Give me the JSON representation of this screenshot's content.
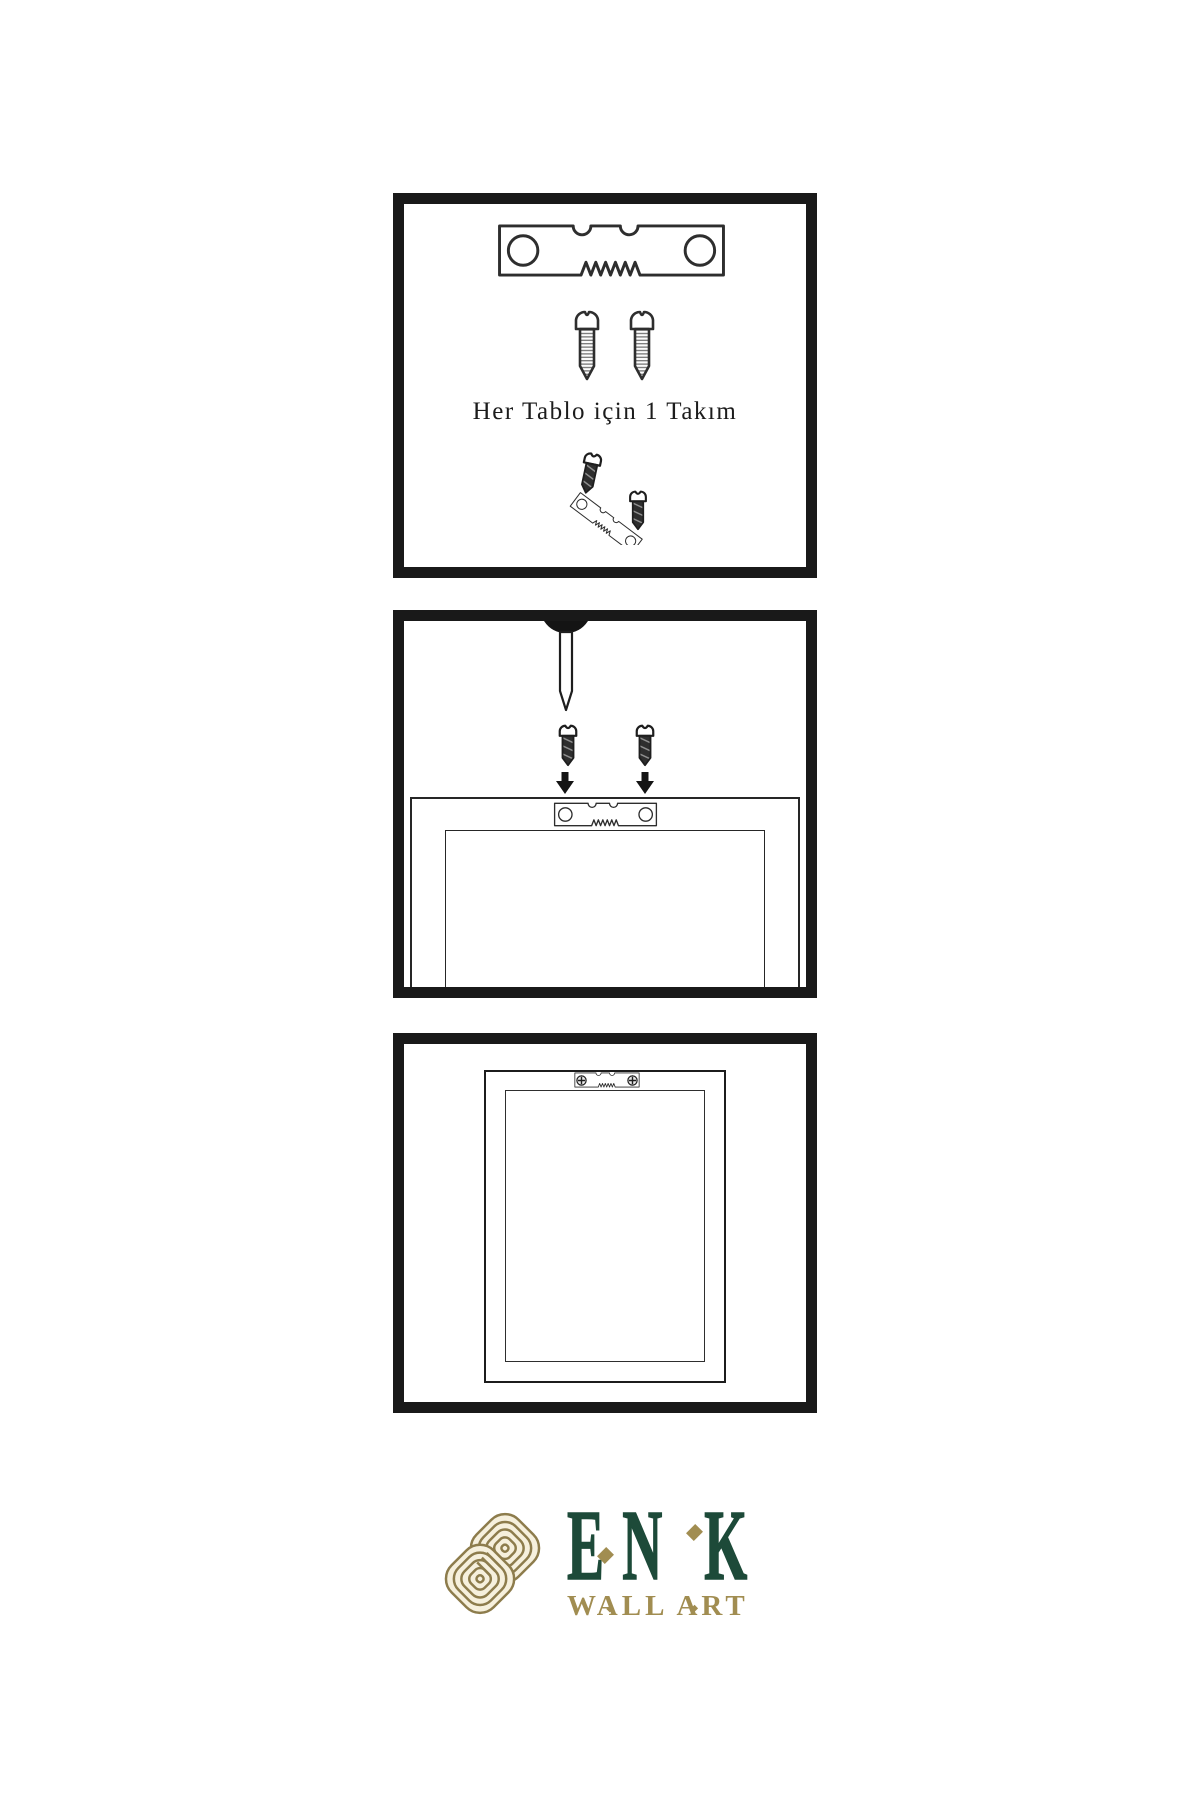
{
  "page": {
    "background": "#ffffff"
  },
  "instruction_panels": {
    "kit": {
      "caption": "Her Tablo için 1 Takım"
    },
    "mounting": {
      "description_icons": [
        "nail-icon",
        "screw-icon",
        "arrow-down-icon",
        "sawtooth-hanger-icon",
        "frame-back-icon"
      ]
    },
    "result": {
      "description_icons": [
        "frame-front-icon",
        "mounted-hanger-icon"
      ]
    }
  },
  "brand": {
    "name": "ENK",
    "letters": [
      "E",
      "N",
      "K"
    ],
    "tagline": "WALL ART",
    "colors": {
      "green": "#1d4a39",
      "gold": "#a18d51",
      "knot_gold": "#8d7c4c",
      "knot_cream": "#f6f0dd",
      "line_black": "#191919"
    }
  }
}
